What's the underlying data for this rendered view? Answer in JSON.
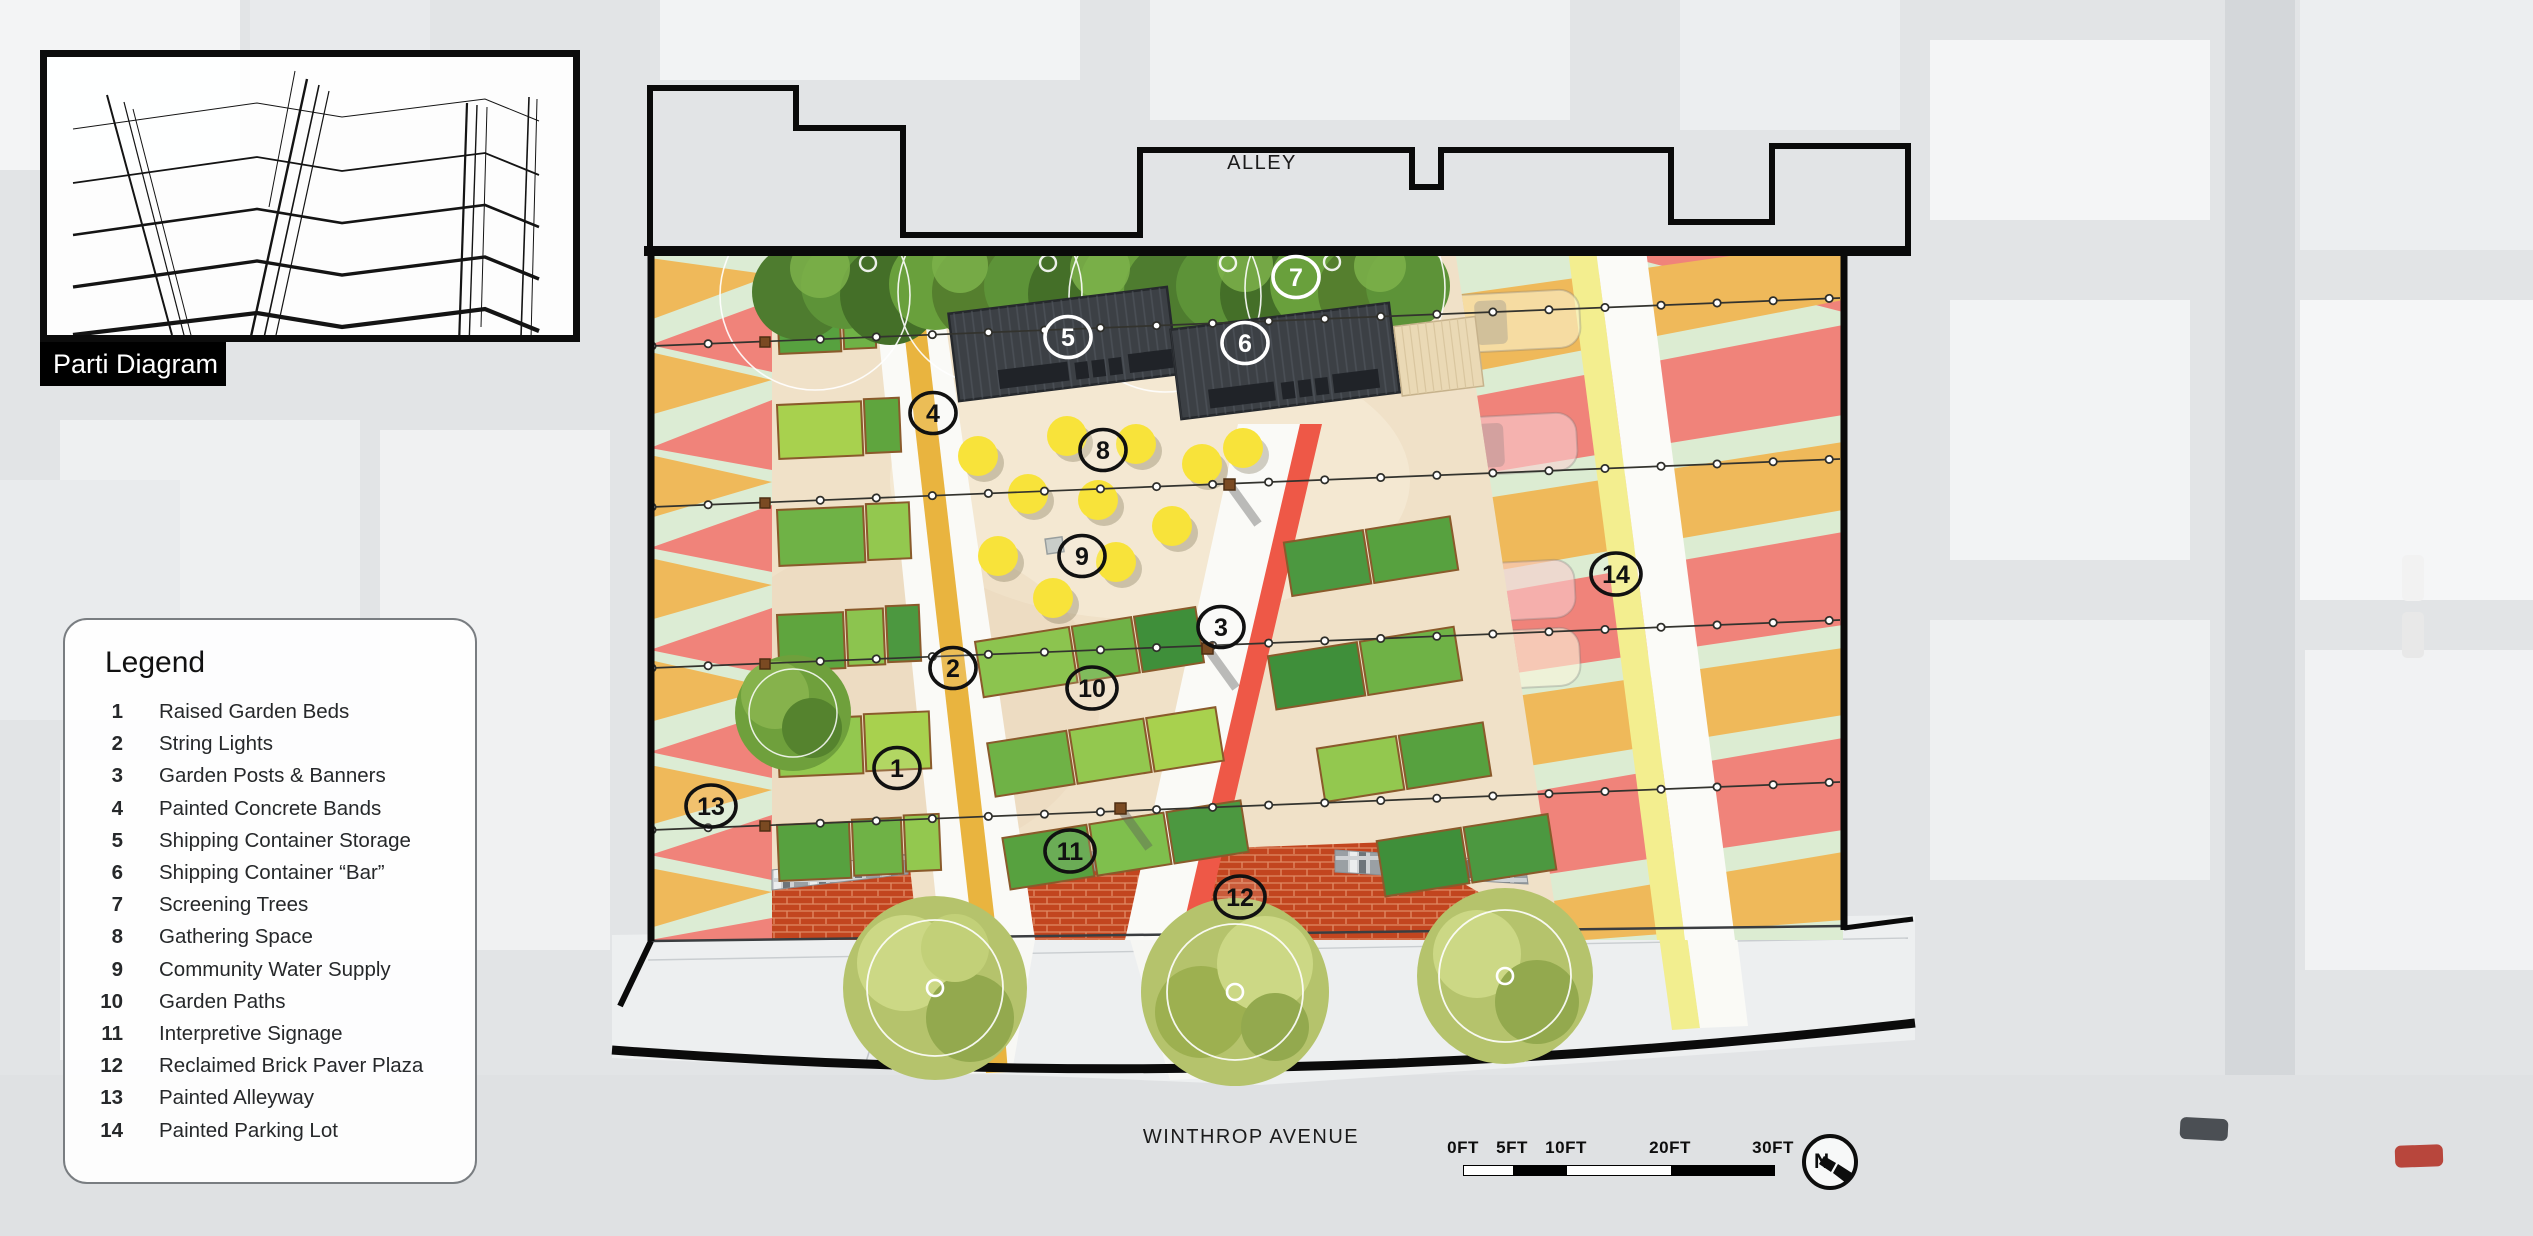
{
  "parti": {
    "label": "Parti Diagram"
  },
  "legend": {
    "title": "Legend",
    "items": [
      {
        "num": "1",
        "label": "Raised Garden Beds"
      },
      {
        "num": "2",
        "label": "String Lights"
      },
      {
        "num": "3",
        "label": "Garden Posts & Banners"
      },
      {
        "num": "4",
        "label": "Painted Concrete Bands"
      },
      {
        "num": "5",
        "label": "Shipping Container Storage"
      },
      {
        "num": "6",
        "label": "Shipping Container “Bar”"
      },
      {
        "num": "7",
        "label": "Screening Trees"
      },
      {
        "num": "8",
        "label": "Gathering Space"
      },
      {
        "num": "9",
        "label": "Community Water Supply"
      },
      {
        "num": "10",
        "label": "Garden Paths"
      },
      {
        "num": "11",
        "label": "Interpretive Signage"
      },
      {
        "num": "12",
        "label": "Reclaimed Brick Paver Plaza"
      },
      {
        "num": "13",
        "label": "Painted Alleyway"
      },
      {
        "num": "14",
        "label": "Painted Parking Lot"
      }
    ]
  },
  "streets": {
    "alley": "ALLEY",
    "avenue": "WINTHROP AVENUE"
  },
  "scalebar": {
    "labels": [
      "0FT",
      "5FT",
      "10FT",
      "20FT",
      "30FT"
    ]
  },
  "compass": {
    "label": "N"
  },
  "markers": {
    "items": [
      {
        "num": "1"
      },
      {
        "num": "2"
      },
      {
        "num": "3"
      },
      {
        "num": "4"
      },
      {
        "num": "5"
      },
      {
        "num": "6"
      },
      {
        "num": "7"
      },
      {
        "num": "8"
      },
      {
        "num": "9"
      },
      {
        "num": "10"
      },
      {
        "num": "11"
      },
      {
        "num": "12"
      },
      {
        "num": "13"
      },
      {
        "num": "14"
      }
    ]
  },
  "colors": {
    "mint": "#dcecd2",
    "amber": "#efb95a",
    "salmon": "#f0837a",
    "tan_plaza": "#f0e1c8",
    "amber_band": "#e9b43f",
    "red_band": "#ee5847",
    "pale_yellow_band": "#f3ee8f",
    "brick": "#c2451f",
    "container": "#3c4045",
    "table_yellow": "#f8e33a",
    "bed_green_light": "#a8d14e",
    "bed_green_dark": "#4c9840"
  }
}
